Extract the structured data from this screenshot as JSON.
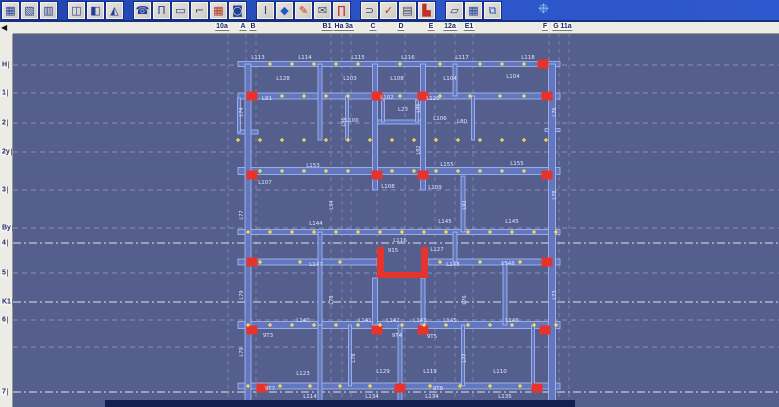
{
  "colors": {
    "canvas_bg": "#555f8e",
    "wall_fill": "#6277c0",
    "wall_edge": "#a9bdf2",
    "column_red": "#e5342e",
    "marker_yellow": "#ffe84a",
    "label_text": "#dde5ff",
    "grid_faint": "#d5c9da",
    "grid_bright": "#f3eff6",
    "dark_bar": "#131f4e",
    "toolbar_blue": "#2c55c8"
  },
  "toolbar": {
    "logo": {
      "name": "swirl-logo-icon",
      "glyph": "❉"
    },
    "groups": [
      {
        "buttons": [
          {
            "name": "spreadsheet-icon",
            "glyph": "▦",
            "color": "#1f3e9c"
          },
          {
            "name": "chart-doc-icon",
            "glyph": "▧",
            "color": "#1f3e9c"
          },
          {
            "name": "clipboard-icon",
            "glyph": "▥",
            "color": "#1f3e9c"
          }
        ]
      },
      {
        "buttons": [
          {
            "name": "frame-plan-icon",
            "glyph": "◫",
            "color": "#1f3e9c"
          },
          {
            "name": "wall-section-icon",
            "glyph": "◧",
            "color": "#1f3e9c"
          },
          {
            "name": "roof-slope-icon",
            "glyph": "◭",
            "color": "#1f3e9c"
          }
        ]
      },
      {
        "buttons": [
          {
            "name": "handset-icon",
            "glyph": "☎",
            "color": "#1f3e9c"
          },
          {
            "name": "column-tool-icon",
            "glyph": "Π",
            "color": "#1f3e9c"
          },
          {
            "name": "beam-tool-icon",
            "glyph": "▭",
            "color": "#1f3e9c"
          },
          {
            "name": "elbow-tool-icon",
            "glyph": "⌐",
            "color": "#1f3e9c"
          },
          {
            "name": "brick-wall-icon",
            "glyph": "▦",
            "color": "#b23322"
          },
          {
            "name": "opening-tool-icon",
            "glyph": "◙",
            "color": "#1f3e9c"
          }
        ]
      },
      {
        "buttons": [
          {
            "name": "pillar-icon",
            "glyph": "I",
            "color": "#1f3e9c"
          },
          {
            "name": "diamond-icon",
            "glyph": "◆",
            "color": "#2255cc"
          },
          {
            "name": "marker-pen-icon",
            "glyph": "✎",
            "color": "#c03028"
          },
          {
            "name": "envelope-icon",
            "glyph": "✉",
            "color": "#3a4470"
          },
          {
            "name": "gate-icon",
            "glyph": "∏",
            "color": "#c03028"
          }
        ]
      },
      {
        "buttons": [
          {
            "name": "undo-icon",
            "glyph": "⊃",
            "color": "#3a4470"
          },
          {
            "name": "check-icon",
            "glyph": "✓",
            "color": "#c03028"
          },
          {
            "name": "report-doc-icon",
            "glyph": "▤",
            "color": "#3a4470"
          },
          {
            "name": "histogram-icon",
            "glyph": "▙",
            "color": "#c03028"
          }
        ]
      },
      {
        "buttons": [
          {
            "name": "sketch-note-icon",
            "glyph": "▱",
            "color": "#1f3e9c"
          },
          {
            "name": "grid-icon",
            "glyph": "▦",
            "color": "#1f3e9c"
          },
          {
            "name": "layers-icon",
            "glyph": "⧉",
            "color": "#2255cc"
          }
        ]
      }
    ]
  },
  "corner": {
    "scroll_left_glyph": "◀"
  },
  "top_ruler": {
    "labels": [
      [
        "10a",
        222
      ],
      [
        "A",
        243
      ],
      [
        "B",
        253
      ],
      [
        "B1",
        327
      ],
      [
        "Ha",
        339
      ],
      [
        "3a",
        349
      ],
      [
        "C",
        373
      ],
      [
        "D",
        401
      ],
      [
        "E",
        431
      ],
      [
        "12a",
        450
      ],
      [
        "E1",
        469
      ],
      [
        "F",
        545
      ],
      [
        "G",
        556
      ],
      [
        "11a",
        566
      ]
    ]
  },
  "left_ruler": {
    "labels": [
      [
        "H",
        65
      ],
      [
        "1",
        93
      ],
      [
        "2",
        123
      ],
      [
        "2y",
        152
      ],
      [
        "3",
        190
      ],
      [
        "By",
        228
      ],
      [
        "4",
        243
      ],
      [
        "5",
        273
      ],
      [
        "K1",
        302
      ],
      [
        "6",
        320
      ],
      [
        "7",
        392
      ]
    ]
  },
  "grid": {
    "h_lines": [
      {
        "y": 65
      },
      {
        "y": 93
      },
      {
        "y": 123
      },
      {
        "y": 152
      },
      {
        "y": 190
      },
      {
        "y": 228
      },
      {
        "y": 243,
        "b": 1
      },
      {
        "y": 273
      },
      {
        "y": 302,
        "b": 1
      },
      {
        "y": 320
      },
      {
        "y": 347
      },
      {
        "y": 392,
        "b": 1
      }
    ],
    "v_lines": [
      228,
      246,
      256,
      331,
      342,
      351,
      377,
      405,
      435,
      455,
      473,
      549,
      559,
      569
    ]
  },
  "plan": {
    "walls_h": [
      [
        238,
        560,
        64,
        5
      ],
      [
        238,
        560,
        96,
        6
      ],
      [
        377,
        423,
        122,
        4
      ],
      [
        238,
        258,
        132,
        4
      ],
      [
        545,
        560,
        130,
        3
      ],
      [
        238,
        560,
        171,
        7
      ],
      [
        238,
        560,
        232,
        5
      ],
      [
        238,
        377,
        262,
        6
      ],
      [
        428,
        560,
        262,
        6
      ],
      [
        238,
        560,
        325,
        7
      ],
      [
        238,
        560,
        386,
        6
      ]
    ],
    "walls_v": [
      [
        248,
        64,
        401,
        6
      ],
      [
        239,
        98,
        132,
        3
      ],
      [
        320,
        64,
        140,
        4
      ],
      [
        320,
        232,
        325,
        4
      ],
      [
        320,
        325,
        401,
        4
      ],
      [
        347,
        96,
        140,
        3
      ],
      [
        350,
        325,
        386,
        3
      ],
      [
        375,
        64,
        190,
        5
      ],
      [
        375,
        278,
        325,
        5
      ],
      [
        400,
        325,
        401,
        4
      ],
      [
        383,
        100,
        122,
        3
      ],
      [
        417,
        100,
        122,
        3
      ],
      [
        423,
        64,
        190,
        5
      ],
      [
        423,
        278,
        325,
        4
      ],
      [
        455,
        64,
        96,
        4
      ],
      [
        455,
        232,
        262,
        4
      ],
      [
        473,
        96,
        140,
        3
      ],
      [
        463,
        176,
        232,
        4
      ],
      [
        463,
        325,
        386,
        3
      ],
      [
        505,
        262,
        325,
        4
      ],
      [
        533,
        325,
        386,
        3
      ],
      [
        552,
        64,
        401,
        7
      ]
    ],
    "core_path": "M377 247 h7 v25 h37 v-25 h7 v31 h-51 Z",
    "columns": [
      [
        252,
        96
      ],
      [
        377,
        96
      ],
      [
        423,
        96
      ],
      [
        547,
        96
      ],
      [
        543,
        64
      ],
      [
        252,
        175
      ],
      [
        377,
        175
      ],
      [
        423,
        175
      ],
      [
        547,
        175
      ],
      [
        252,
        262
      ],
      [
        547,
        262
      ],
      [
        252,
        330
      ],
      [
        377,
        330
      ],
      [
        423,
        330
      ],
      [
        545,
        330
      ],
      [
        262,
        388
      ],
      [
        400,
        388
      ],
      [
        537,
        388
      ]
    ],
    "marker_rows": [
      {
        "y": 64,
        "xs": [
          270,
          292,
          314,
          336,
          358,
          400,
          440,
          480,
          502,
          524
        ]
      },
      {
        "y": 96,
        "xs": [
          282,
          304,
          326,
          348,
          400,
          440,
          470,
          500,
          524
        ]
      },
      {
        "y": 140,
        "xs": [
          238,
          260,
          282,
          304,
          326,
          348,
          370,
          392,
          414,
          436,
          458,
          480,
          502,
          524,
          546
        ]
      },
      {
        "y": 171,
        "xs": [
          260,
          282,
          304,
          326,
          348,
          392,
          414,
          436,
          458,
          480,
          502,
          524
        ]
      },
      {
        "y": 232,
        "xs": [
          248,
          270,
          292,
          314,
          336,
          358,
          380,
          402,
          424,
          446,
          468,
          490,
          512,
          534,
          556
        ]
      },
      {
        "y": 262,
        "xs": [
          260,
          300,
          340,
          440,
          480,
          520
        ]
      },
      {
        "y": 325,
        "xs": [
          248,
          270,
          292,
          314,
          336,
          358,
          380,
          402,
          424,
          446,
          468,
          490,
          512,
          534,
          556
        ]
      },
      {
        "y": 386,
        "xs": [
          248,
          280,
          310,
          340,
          370,
          430,
          460,
          490,
          520
        ]
      }
    ],
    "labels": [
      [
        258,
        59,
        "L113"
      ],
      [
        305,
        59,
        "L114"
      ],
      [
        358,
        59,
        "L115"
      ],
      [
        408,
        59,
        "L116"
      ],
      [
        462,
        59,
        "L117"
      ],
      [
        528,
        59,
        "L118"
      ],
      [
        283,
        80,
        "L128"
      ],
      [
        350,
        80,
        "L103"
      ],
      [
        397,
        80,
        "L108"
      ],
      [
        450,
        80,
        "L104"
      ],
      [
        513,
        78,
        "L104"
      ],
      [
        267,
        100,
        "L91"
      ],
      [
        387,
        99,
        "L102"
      ],
      [
        433,
        100,
        "L126"
      ],
      [
        403,
        111,
        "L23"
      ],
      [
        352,
        122,
        "L100"
      ],
      [
        440,
        120,
        "L106"
      ],
      [
        462,
        123,
        "L80"
      ],
      [
        313,
        167,
        "L153"
      ],
      [
        447,
        166,
        "L155"
      ],
      [
        517,
        165,
        "L155"
      ],
      [
        265,
        184,
        "L107"
      ],
      [
        388,
        188,
        "L108"
      ],
      [
        435,
        189,
        "L109"
      ],
      [
        316,
        225,
        "L144"
      ],
      [
        445,
        223,
        "L145"
      ],
      [
        512,
        223,
        "L145"
      ],
      [
        400,
        242,
        "L116"
      ],
      [
        393,
        252,
        "915"
      ],
      [
        437,
        251,
        "L127"
      ],
      [
        316,
        266,
        "L147"
      ],
      [
        453,
        266,
        "L148"
      ],
      [
        508,
        265,
        "L148"
      ],
      [
        303,
        322,
        "L140"
      ],
      [
        365,
        322,
        "L141"
      ],
      [
        393,
        322,
        "L142"
      ],
      [
        420,
        322,
        "L143"
      ],
      [
        450,
        322,
        "L145"
      ],
      [
        512,
        322,
        "L146"
      ],
      [
        268,
        337,
        "9T3"
      ],
      [
        397,
        337,
        "9T4"
      ],
      [
        432,
        338,
        "9T5"
      ],
      [
        303,
        375,
        "L123"
      ],
      [
        383,
        373,
        "L129"
      ],
      [
        430,
        373,
        "L119"
      ],
      [
        500,
        373,
        "L110"
      ],
      [
        270,
        390,
        "9T7"
      ],
      [
        438,
        390,
        "9T8"
      ],
      [
        310,
        398,
        "L114"
      ],
      [
        372,
        398,
        "L134"
      ],
      [
        432,
        398,
        "L134"
      ],
      [
        505,
        398,
        "L135"
      ]
    ],
    "vlabels": [
      [
        243,
        112,
        "L74"
      ],
      [
        243,
        215,
        "L77"
      ],
      [
        243,
        295,
        "L79"
      ],
      [
        243,
        352,
        "L79"
      ],
      [
        556,
        112,
        "L76"
      ],
      [
        556,
        195,
        "L78"
      ],
      [
        556,
        295,
        "L73"
      ],
      [
        345,
        122,
        "L96"
      ],
      [
        420,
        150,
        "L92"
      ],
      [
        420,
        108,
        "L95"
      ],
      [
        333,
        205,
        "L94"
      ],
      [
        466,
        205,
        "L92"
      ],
      [
        333,
        300,
        "L78"
      ],
      [
        466,
        300,
        "L76"
      ],
      [
        355,
        358,
        "L78"
      ],
      [
        466,
        358,
        "L77"
      ]
    ],
    "dark_bar": [
      105,
      400,
      470,
      7
    ]
  }
}
